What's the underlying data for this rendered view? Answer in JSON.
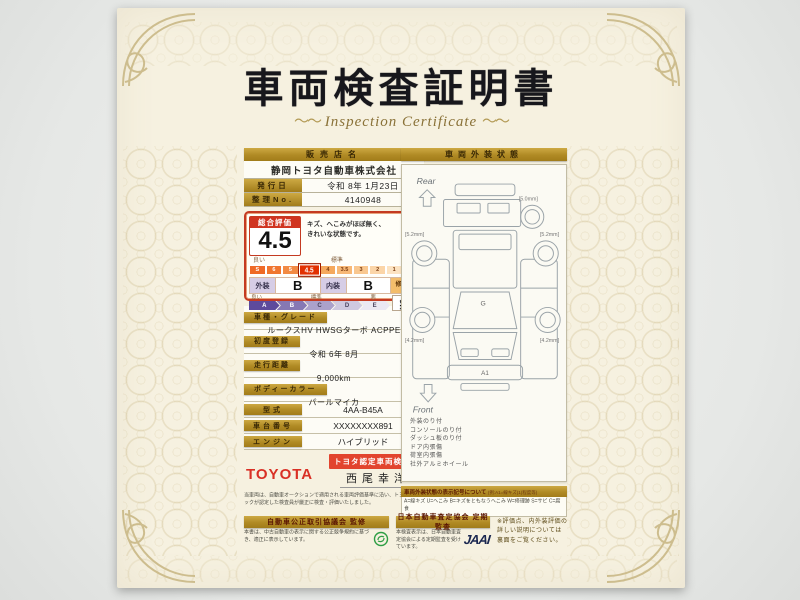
{
  "title": {
    "ja": "車両検査証明書",
    "en": "Inspection Certificate",
    "flourish": "～～"
  },
  "dealer": {
    "header": "販売店名",
    "name": "静岡トヨタ自動車株式会社",
    "issue_label": "発行日",
    "issue_value": "令和 8年 1月23日",
    "ref_label": "整理No.",
    "ref_value": "4140948"
  },
  "evaluation": {
    "header": "総合評価",
    "score": "4.5",
    "comment_line1": "キズ、へこみがほぼ無く、",
    "comment_line2": "きれいな状態です。",
    "scale_label_left": "良い",
    "scale_label_mid": "標準",
    "scale_label_right": "R",
    "scale": [
      "S",
      "6",
      "5",
      "4.5",
      "4",
      "3.5",
      "3",
      "2",
      "1",
      "R"
    ],
    "highlight": "4.5",
    "exterior_label": "外装",
    "exterior_value": "B",
    "interior_label": "内装",
    "interior_value": "B",
    "repair_label": "修復歴",
    "repair_value": "無",
    "grade_label_left": "良い",
    "grade_label_mid": "標準",
    "grade_label_right": "悪",
    "grades": [
      "A",
      "B",
      "C",
      "D",
      "E"
    ]
  },
  "vehicle": {
    "rows_stacked": [
      {
        "label": "車種・グレード",
        "value": "ルークスHV HWSGターボ ACPPE"
      },
      {
        "label": "初度登録",
        "value": "令和 6年 8月"
      },
      {
        "label": "走行距離",
        "value": "9,000km"
      },
      {
        "label": "ボディーカラー",
        "value": "パールマイカ"
      }
    ],
    "rows_inline": [
      {
        "label": "型式",
        "value": "4AA-B45A"
      },
      {
        "label": "車台番号",
        "value": "XXXXXXXX891"
      },
      {
        "label": "エンジン",
        "value": "ハイブリッド"
      }
    ]
  },
  "certifier": {
    "brand": "TOYOTA",
    "badge": "トヨタ認定車両検査員",
    "inspector": "西尾幸洋",
    "note": "当車両は、自動車オークションで適用される車両評価基準に沿い、トヨタユーゼックが認定した検査員が厳正に検査・評価いたしました。"
  },
  "exterior_panel": {
    "header": "車両外装状態",
    "rear": "Rear",
    "front": "Front",
    "marks": {
      "windshield": "G",
      "front_bumper": "A1"
    },
    "tires": {
      "spare": "[5.0mm]",
      "rear_left": "[5.2mm]",
      "rear_right": "[5.2mm]",
      "front_left": "[4.2mm]",
      "front_right": "[4.2mm]"
    },
    "notes": [
      "外装のり付",
      "コンソールのり付",
      "ダッシュ板のり付",
      "ドア内張傷",
      "荷室内張傷",
      "社外アルミホイール"
    ]
  },
  "legend": {
    "header": "車両外装状態の表示記号について",
    "example": "(例:A1=線キズ(1)程度等)",
    "lines": [
      "A=線キズ U=へこみ B=キズをともなうへこみ W=修理跡 S=サビ C=腐食",
      "P=塗装ハガレ・変色 X=要交換 XX=交換済み G=ガラス飛び石 Y=ワレ",
      "1=小 2=中 3=大程度以上 ※タイヤ残り溝は実測値を記載しています。"
    ]
  },
  "footer": {
    "fairtrade_bar": "自動車公正取引協議会 監修",
    "fairtrade_text": "本書は、中古自動車の表示に関する公正競争規約に基づき、適正に表示しています。",
    "jaai_bar": "日本自動車査定協会 定期監査",
    "jaai_text": "本検査表示は、日本自動車査定協会による定期監査を受けています。",
    "jaai_logo": "JAAI",
    "back_note_line1": "※評価点、内外装評価の",
    "back_note_line2": "詳しい説明については",
    "back_note_line3": "裏面をご覧ください。"
  }
}
